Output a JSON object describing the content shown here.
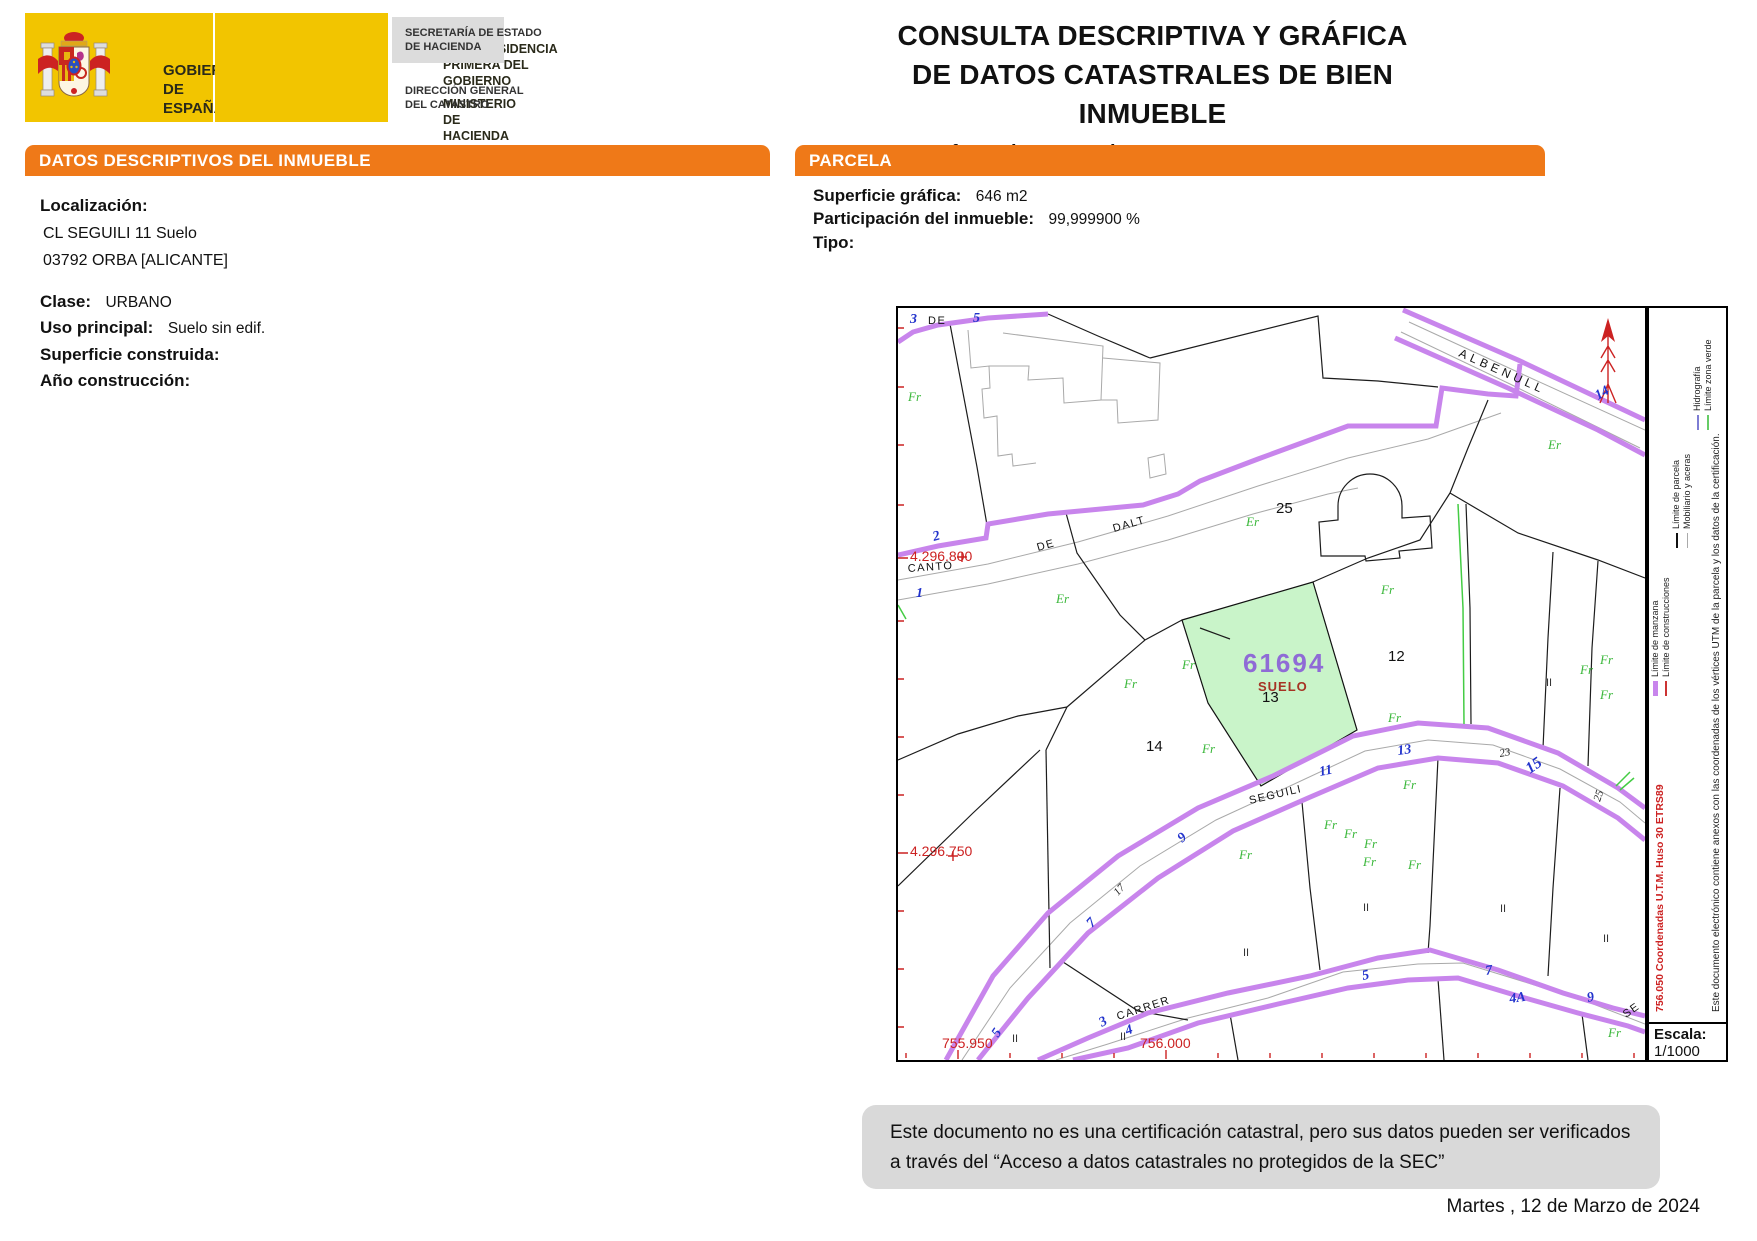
{
  "header": {
    "gobierno_line1": "GOBIERNO",
    "gobierno_line2": "DE ESPAÑA",
    "vice_line1": "VICEPRESIDENCIA",
    "vice_line2": "PRIMERA DEL GOBIERNO",
    "min_line1": "MINISTERIO",
    "min_line2": "DE HACIENDA",
    "sec_line1": "SECRETARÍA DE ESTADO",
    "sec_line2": "DE HACIENDA",
    "dir_line1": "DIRECCIÓN GENERAL",
    "dir_line2": "DEL CATASTRO",
    "title_line1": "CONSULTA DESCRIPTIVA Y GRÁFICA",
    "title_line2": "DE DATOS CATASTRALES DE BIEN INMUEBLE",
    "ref_label": "Referencia catastral:",
    "ref_value": "6169413YH5966N0001KA"
  },
  "datos": {
    "header_prefix": "DATOS DESCRIPTIVOS DEL ",
    "header_bold": "INMUEBLE",
    "localizacion_label": "Localización:",
    "address_line1": "CL SEGUILI 11 Suelo",
    "address_line2": "03792 ORBA [ALICANTE]",
    "clase_label": "Clase:",
    "clase_value": "URBANO",
    "uso_label": "Uso principal:",
    "uso_value": "Suelo sin edif.",
    "superficie_label": "Superficie construida:",
    "superficie_value": "",
    "anio_label": "Año construcción:",
    "anio_value": ""
  },
  "parcela": {
    "header": "PARCELA",
    "superficie_label": "Superficie gráfica:",
    "superficie_value": "646 m2",
    "participacion_label": "Participación del inmueble:",
    "participacion_value": "99,999900 %",
    "tipo_label": "Tipo:",
    "tipo_value": ""
  },
  "map": {
    "parcel_id": "61694",
    "parcel_tag": "SUELO",
    "labels": [
      {
        "t": "3",
        "x": 12,
        "y": 15,
        "r": 0,
        "c": "blue"
      },
      {
        "t": "DE",
        "x": 30,
        "y": 16,
        "r": 0,
        "c": "street"
      },
      {
        "t": "5",
        "x": 75,
        "y": 14,
        "r": 0,
        "c": "blue"
      },
      {
        "t": "Fr",
        "x": 10,
        "y": 93,
        "r": 0,
        "c": "gr"
      },
      {
        "t": "2",
        "x": 36,
        "y": 233,
        "r": -15,
        "c": "blue"
      },
      {
        "t": "4.296.800",
        "x": 12,
        "y": 253,
        "r": 0,
        "c": "red"
      },
      {
        "t": "CANTO",
        "x": 10,
        "y": 264,
        "r": -4,
        "c": "street"
      },
      {
        "t": "1",
        "x": 18,
        "y": 289,
        "r": 0,
        "c": "blue"
      },
      {
        "t": "DE",
        "x": 140,
        "y": 243,
        "r": -16,
        "c": "street"
      },
      {
        "t": "DALT",
        "x": 216,
        "y": 224,
        "r": -16,
        "c": "street"
      },
      {
        "t": "Er",
        "x": 158,
        "y": 295,
        "r": 0,
        "c": "gr"
      },
      {
        "t": "Er",
        "x": 348,
        "y": 218,
        "r": 0,
        "c": "gr"
      },
      {
        "t": "25",
        "x": 378,
        "y": 205,
        "r": 0,
        "c": "pnum"
      },
      {
        "t": "ALBENULL",
        "x": 560,
        "y": 48,
        "r": 24,
        "c": "alben"
      },
      {
        "t": "14",
        "x": 700,
        "y": 92,
        "r": -30,
        "c": "blue"
      },
      {
        "t": "Er",
        "x": 650,
        "y": 141,
        "r": 0,
        "c": "gr"
      },
      {
        "t": "Fr",
        "x": 226,
        "y": 380,
        "r": 0,
        "c": "gr"
      },
      {
        "t": "Fr",
        "x": 284,
        "y": 361,
        "r": 0,
        "c": "gr"
      },
      {
        "t": "Fr",
        "x": 304,
        "y": 445,
        "r": 0,
        "c": "gr"
      },
      {
        "t": "Fr",
        "x": 483,
        "y": 286,
        "r": 0,
        "c": "gr"
      },
      {
        "t": "Fr",
        "x": 490,
        "y": 414,
        "r": 0,
        "c": "gr"
      },
      {
        "t": "14",
        "x": 248,
        "y": 443,
        "r": 0,
        "c": "pnum"
      },
      {
        "t": "12",
        "x": 490,
        "y": 353,
        "r": 0,
        "c": "pnum"
      },
      {
        "t": "13",
        "x": 364,
        "y": 394,
        "r": 0,
        "c": "pnum"
      },
      {
        "t": "9",
        "x": 284,
        "y": 535,
        "r": -40,
        "c": "blue"
      },
      {
        "t": "7",
        "x": 194,
        "y": 620,
        "r": -48,
        "c": "blue"
      },
      {
        "t": "17",
        "x": 220,
        "y": 588,
        "r": -48,
        "c": "bsmall"
      },
      {
        "t": "5",
        "x": 100,
        "y": 730,
        "r": -55,
        "c": "blue"
      },
      {
        "t": "SEGUILI",
        "x": 352,
        "y": 496,
        "r": -13,
        "c": "street"
      },
      {
        "t": "11",
        "x": 422,
        "y": 468,
        "r": -11,
        "c": "blue"
      },
      {
        "t": "13",
        "x": 500,
        "y": 447,
        "r": -8,
        "c": "blue"
      },
      {
        "t": "23",
        "x": 602,
        "y": 449,
        "r": -10,
        "c": "bsmall"
      },
      {
        "t": "15",
        "x": 632,
        "y": 466,
        "r": -35,
        "c": "blueL"
      },
      {
        "t": "25",
        "x": 702,
        "y": 494,
        "r": -72,
        "c": "bsmall"
      },
      {
        "t": "Fr",
        "x": 505,
        "y": 481,
        "r": 0,
        "c": "gr"
      },
      {
        "t": "Fr",
        "x": 341,
        "y": 551,
        "r": 0,
        "c": "gr"
      },
      {
        "t": "Fr",
        "x": 426,
        "y": 521,
        "r": 0,
        "c": "gr"
      },
      {
        "t": "Fr",
        "x": 446,
        "y": 530,
        "r": 0,
        "c": "gr"
      },
      {
        "t": "Fr",
        "x": 466,
        "y": 540,
        "r": 0,
        "c": "gr"
      },
      {
        "t": "Fr",
        "x": 465,
        "y": 558,
        "r": 0,
        "c": "gr"
      },
      {
        "t": "Fr",
        "x": 510,
        "y": 561,
        "r": 0,
        "c": "gr"
      },
      {
        "t": "Fr",
        "x": 682,
        "y": 366,
        "r": 0,
        "c": "gr"
      },
      {
        "t": "Fr",
        "x": 702,
        "y": 356,
        "r": 0,
        "c": "gr"
      },
      {
        "t": "Fr",
        "x": 702,
        "y": 391,
        "r": 0,
        "c": "gr"
      },
      {
        "t": "Fr",
        "x": 710,
        "y": 729,
        "r": 0,
        "c": "gr"
      },
      {
        "t": "II",
        "x": 114,
        "y": 734,
        "r": 0,
        "c": "roman"
      },
      {
        "t": "II",
        "x": 222,
        "y": 732,
        "r": 0,
        "c": "roman"
      },
      {
        "t": "II",
        "x": 345,
        "y": 648,
        "r": 0,
        "c": "roman"
      },
      {
        "t": "II",
        "x": 465,
        "y": 603,
        "r": 0,
        "c": "roman"
      },
      {
        "t": "II",
        "x": 602,
        "y": 604,
        "r": 0,
        "c": "roman"
      },
      {
        "t": "II",
        "x": 705,
        "y": 634,
        "r": 0,
        "c": "roman"
      },
      {
        "t": "II",
        "x": 648,
        "y": 378,
        "r": 0,
        "c": "roman"
      },
      {
        "t": "4.296.750",
        "x": 12,
        "y": 548,
        "r": 0,
        "c": "red"
      },
      {
        "t": "755.950",
        "x": 44,
        "y": 740,
        "r": 0,
        "c": "red"
      },
      {
        "t": "756.000",
        "x": 242,
        "y": 740,
        "r": 0,
        "c": "red"
      },
      {
        "t": "3",
        "x": 204,
        "y": 719,
        "r": -30,
        "c": "blue"
      },
      {
        "t": "CARRER",
        "x": 220,
        "y": 712,
        "r": -18,
        "c": "street"
      },
      {
        "t": "4",
        "x": 229,
        "y": 727,
        "r": -20,
        "c": "blue"
      },
      {
        "t": "5",
        "x": 465,
        "y": 672,
        "r": -12,
        "c": "blue"
      },
      {
        "t": "7",
        "x": 588,
        "y": 667,
        "r": -8,
        "c": "blue"
      },
      {
        "t": "4A",
        "x": 612,
        "y": 695,
        "r": -8,
        "c": "blue"
      },
      {
        "t": "9",
        "x": 690,
        "y": 694,
        "r": -12,
        "c": "blue"
      },
      {
        "t": "SE",
        "x": 728,
        "y": 710,
        "r": -35,
        "c": "street"
      }
    ]
  },
  "legend": {
    "items": [
      {
        "label": "Límite de manzana",
        "color": "#c885ec",
        "h": 5,
        "x": 322,
        "row": 0
      },
      {
        "label": "Límite de construcciones",
        "color": "#cc3333",
        "h": 2,
        "x": 322,
        "row": 1
      },
      {
        "label": "Límite de parcela",
        "color": "#111111",
        "h": 2,
        "x": 470,
        "row": 2
      },
      {
        "label": "Mobiliario y aceras",
        "color": "#aaaaaa",
        "h": 1,
        "x": 470,
        "row": 3
      },
      {
        "label": "Hidrografía",
        "color": "#7d7dd4",
        "h": 2,
        "x": 588,
        "row": 4
      },
      {
        "label": "Límite zona verde",
        "color": "#66cc66",
        "h": 2,
        "x": 588,
        "row": 5
      }
    ],
    "red_note": "756.050  Coordenadas U.T.M. Huso 30 ETRS89",
    "side_note": "Este documento electrónico contiene anexos con las coordenadas de los vértices UTM de la parcela y los datos de la certificación.",
    "escala_label": "Escala:",
    "escala_value": "1/1000"
  },
  "footer": {
    "disclaimer": "Este documento no es una certificación catastral, pero sus datos pueden ser verificados a través del “Acceso a datos catastrales no protegidos de la SEC”",
    "date": "Martes , 12 de Marzo de 2024"
  }
}
